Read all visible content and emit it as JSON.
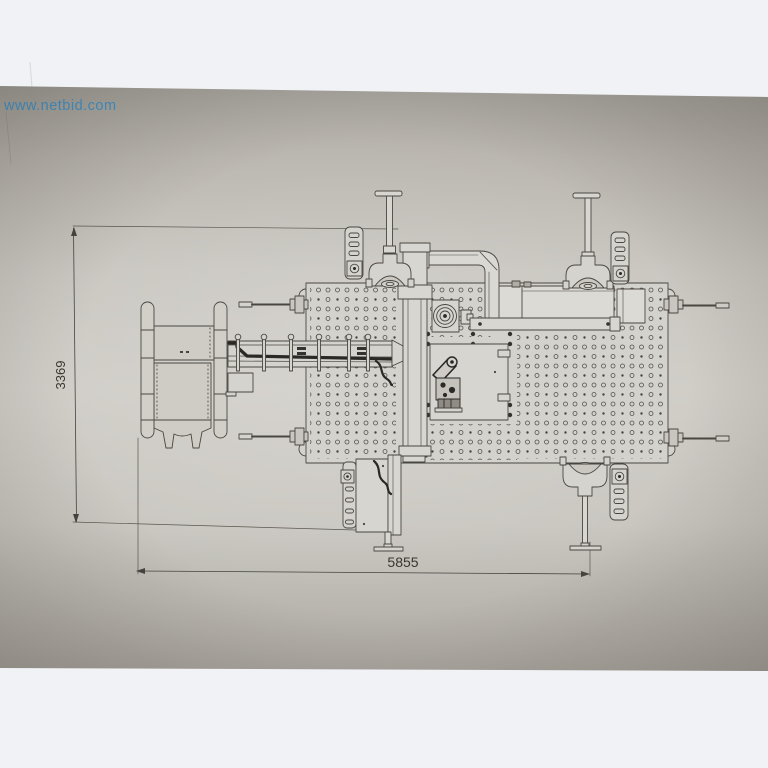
{
  "page": {
    "background": "#f1f2f5"
  },
  "photo": {
    "paper_color": "#c9c6c0",
    "line_color": "#4a4741",
    "description": "photo of a technical top-view drawing of a machine line"
  },
  "watermark": {
    "text": "www.netbid.com",
    "color": "#3590d2"
  },
  "dimensions": {
    "height_label": "3369",
    "width_label": "5855"
  }
}
